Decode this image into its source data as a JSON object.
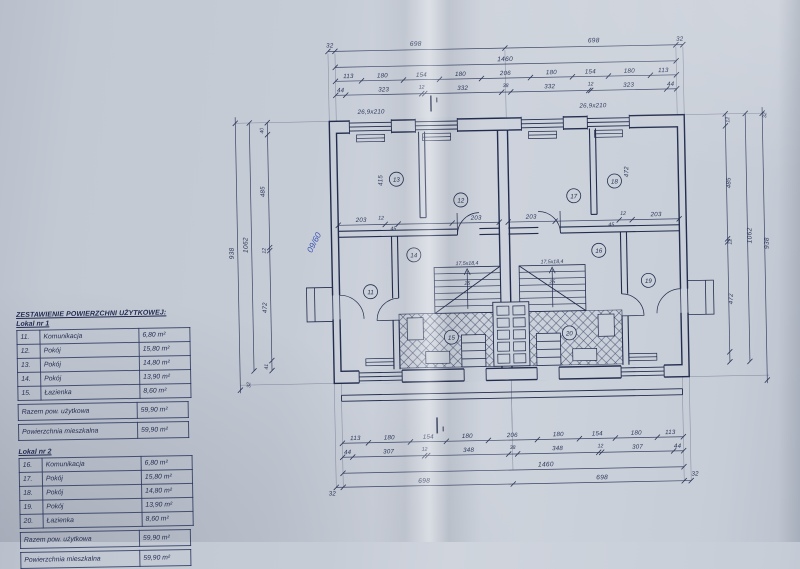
{
  "tables": {
    "title": "ZESTAWIENIE POWIERZCHNI UŻYTKOWEJ:",
    "razem_label": "Razem pow. użytkowa",
    "mieszkalna_label": "Powierzchnia mieszkalna",
    "lokal1": {
      "label": "Lokal nr 1",
      "rows": [
        {
          "no": "11.",
          "name": "Komunikacja",
          "area": "6,80 m²"
        },
        {
          "no": "12.",
          "name": "Pokój",
          "area": "15,80 m²"
        },
        {
          "no": "13.",
          "name": "Pokój",
          "area": "14,80 m²"
        },
        {
          "no": "14.",
          "name": "Pokój",
          "area": "13,90 m²"
        },
        {
          "no": "15.",
          "name": "Łazienka",
          "area": "8,60 m²"
        }
      ],
      "razem": "59,90 m²",
      "mieszkalna": "59,90 m²"
    },
    "lokal2": {
      "label": "Lokal nr 2",
      "rows": [
        {
          "no": "16.",
          "name": "Komunikacja",
          "area": "6,80 m²"
        },
        {
          "no": "17.",
          "name": "Pokój",
          "area": "15,80 m²"
        },
        {
          "no": "18.",
          "name": "Pokój",
          "area": "14,80 m²"
        },
        {
          "no": "19.",
          "name": "Pokój",
          "area": "13,90 m²"
        },
        {
          "no": "20.",
          "name": "Łazienka",
          "area": "8,60 m²"
        }
      ],
      "razem": "59,90 m²",
      "mieszkalna": "59,90 m²"
    }
  },
  "plan": {
    "rooms": [
      "11",
      "12",
      "13",
      "14",
      "15",
      "16",
      "17",
      "18",
      "19",
      "20"
    ],
    "dims": {
      "top_outer": [
        "32",
        "698",
        "1460",
        "698",
        "32"
      ],
      "top_axes": [
        "113",
        "180",
        "154",
        "180",
        "206",
        "180",
        "154",
        "180",
        "113"
      ],
      "top_walls": [
        "44",
        "323",
        "12",
        "332",
        "38",
        "332",
        "12",
        "323",
        "44"
      ],
      "bottom_axes": [
        "113",
        "180",
        "154",
        "180",
        "206",
        "180",
        "154",
        "180",
        "113"
      ],
      "bottom_walls": [
        "44",
        "307",
        "12",
        "348",
        "38",
        "348",
        "12",
        "307",
        "44"
      ],
      "bottom_outer": [
        "698",
        "1460",
        "698",
        "32",
        "32"
      ],
      "left": {
        "chain": [
          "40",
          "485",
          "12",
          "472",
          "41"
        ],
        "inner": "1062",
        "outer": "938",
        "bottom": "32"
      },
      "right": {
        "chain": [
          "12",
          "485",
          "12",
          "472"
        ],
        "inner": "1062",
        "outer": "938",
        "top": "32"
      },
      "interior": [
        "203",
        "12",
        "45",
        "203",
        "203",
        "45",
        "12",
        "203"
      ],
      "room13_depth": "415",
      "room18_depth": "472"
    },
    "stair": {
      "label": "17,5x18,4",
      "count": "25"
    },
    "window_label": "26,9x210",
    "section_mark": "I",
    "handwritten_note": "09/60"
  }
}
